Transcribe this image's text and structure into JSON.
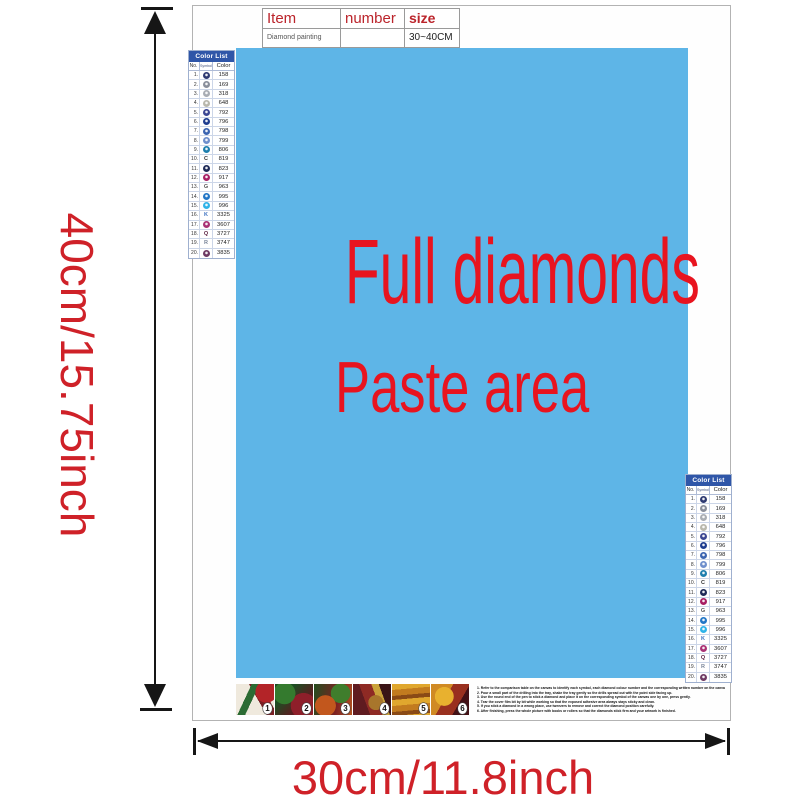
{
  "colors": {
    "paste_bg": "#5eb5e7",
    "paste_text": "#e8141f",
    "dimension_text": "#cf2128",
    "table_header_text": "#bb242b",
    "color_list_header_bg": "#2f56a8",
    "arrow": "#161616"
  },
  "dimensions": {
    "height_label": "40cm/15.75inch",
    "width_label": "30cm/11.8inch"
  },
  "paste_area": {
    "line1": "Full diamonds",
    "line2": "Paste area"
  },
  "item_table": {
    "headers": [
      "Item",
      "number",
      "size"
    ],
    "row": [
      "Diamond painting",
      "",
      "30~40CM"
    ]
  },
  "color_list": {
    "title": "Color List",
    "columns": [
      "No.",
      "Symbol",
      "Color"
    ],
    "rows": [
      {
        "no": "1.",
        "symbol": "circle",
        "color": "#2e3a72",
        "code": "158"
      },
      {
        "no": "2.",
        "symbol": "circle",
        "color": "#8a8f9b",
        "code": "169"
      },
      {
        "no": "3.",
        "symbol": "circle",
        "color": "#a9adb3",
        "code": "318"
      },
      {
        "no": "4.",
        "symbol": "circle",
        "color": "#b9b8ac",
        "code": "648"
      },
      {
        "no": "5.",
        "symbol": "circle",
        "color": "#3c4793",
        "code": "792"
      },
      {
        "no": "6.",
        "symbol": "circle",
        "color": "#1e3d8f",
        "code": "796"
      },
      {
        "no": "7.",
        "symbol": "circle",
        "color": "#3b64b0",
        "code": "798"
      },
      {
        "no": "8.",
        "symbol": "circle",
        "color": "#6f8fcc",
        "code": "799"
      },
      {
        "no": "9.",
        "symbol": "circle",
        "color": "#1d7fae",
        "code": "806"
      },
      {
        "no": "10.",
        "symbol": "letter",
        "letter": "C",
        "color": "#333333",
        "code": "819"
      },
      {
        "no": "11.",
        "symbol": "circle",
        "color": "#1f2a57",
        "code": "823"
      },
      {
        "no": "12.",
        "symbol": "circle",
        "color": "#a81f63",
        "code": "917"
      },
      {
        "no": "13.",
        "symbol": "letter",
        "letter": "G",
        "color": "#555555",
        "code": "963"
      },
      {
        "no": "14.",
        "symbol": "circle",
        "color": "#2276c6",
        "code": "995"
      },
      {
        "no": "15.",
        "symbol": "circle",
        "color": "#2fb3e8",
        "code": "996"
      },
      {
        "no": "16.",
        "symbol": "letter",
        "letter": "K",
        "color": "#3a6fbf",
        "code": "3325"
      },
      {
        "no": "17.",
        "symbol": "circle",
        "color": "#a93275",
        "code": "3607"
      },
      {
        "no": "18.",
        "symbol": "letter",
        "letter": "Q",
        "color": "#5a1f3f",
        "code": "3727"
      },
      {
        "no": "19.",
        "symbol": "letter",
        "letter": "R",
        "color": "#7a8699",
        "code": "3747"
      },
      {
        "no": "20.",
        "symbol": "circle",
        "color": "#6e3a63",
        "code": "3835"
      }
    ]
  },
  "steps": {
    "numbers": [
      "1",
      "2",
      "3",
      "4",
      "5",
      "6"
    ]
  },
  "instructions": {
    "lines": [
      "1.  Refer to the comparison table on the canvas to identify each symbol, each diamond colour number and the corresponding written number on the canvas.",
      "2.  Pour a small part of the drilling into the tray, shake the tray gently so the drills spread out with the point side facing up.",
      "3.  Use the round end of the pen to stick a diamond and place it on the corresponding symbol of the canvas one by one, press gently.",
      "4.  Tear the cover film bit by bit while working so that the exposed adhesive area always stays sticky and clean.",
      "5.  If you stick a diamond in a wrong place, use tweezers to remove and correct the diamond position carefully.",
      "6.  After finishing, press the whole picture with books or rollers so that the diamonds stick firm and your artwork is finished."
    ]
  }
}
